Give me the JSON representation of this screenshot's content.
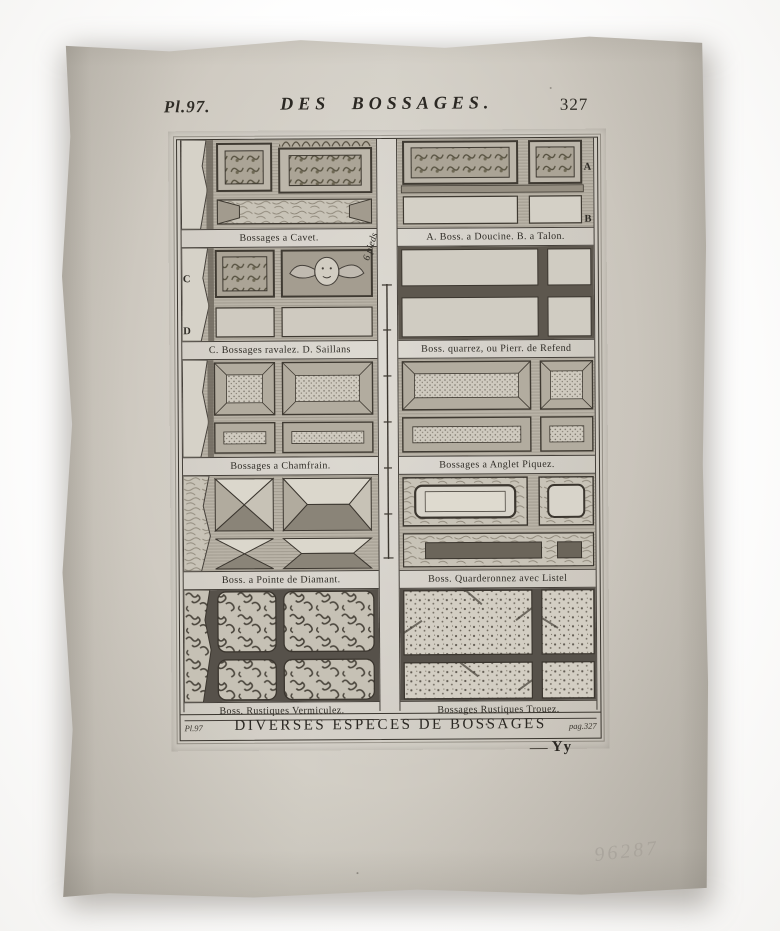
{
  "document": {
    "header": {
      "plate_label": "Pl.97.",
      "title": "DES BOSSAGES.",
      "page_number": "327"
    },
    "letters": {
      "a": "A",
      "b": "B",
      "c": "C",
      "d": "D"
    },
    "figures": [
      {
        "caption": "Bossages a Cavet."
      },
      {
        "caption": "A. Boss. a Doucine. B. a Talon."
      },
      {
        "caption": "C. Bossages ravalez. D. Saillans"
      },
      {
        "caption": "Boss. quarrez, ou Pierr. de Refend"
      },
      {
        "caption": "Bossages a Chamfrain."
      },
      {
        "caption": "Bossages a Anglet Piquez."
      },
      {
        "caption": "Boss. a Pointe de Diamant."
      },
      {
        "caption": "Boss. Quarderonnez avec Listel"
      },
      {
        "caption": "Boss. Rustiques Vermiculez."
      },
      {
        "caption": "Bossages Rustiques Trouez."
      }
    ],
    "scale_label": "6 pieds",
    "footer": {
      "plate_ref": "Pl.97",
      "title": "DIVERSES ESPECES DE BOSSAGES",
      "page_ref": "pag.327",
      "signature": "Yy"
    },
    "handwritten_number": "96287",
    "colors": {
      "paper": "#cdc8bf",
      "ink": "#2f2c26",
      "pencil": "#a8a39b"
    }
  }
}
